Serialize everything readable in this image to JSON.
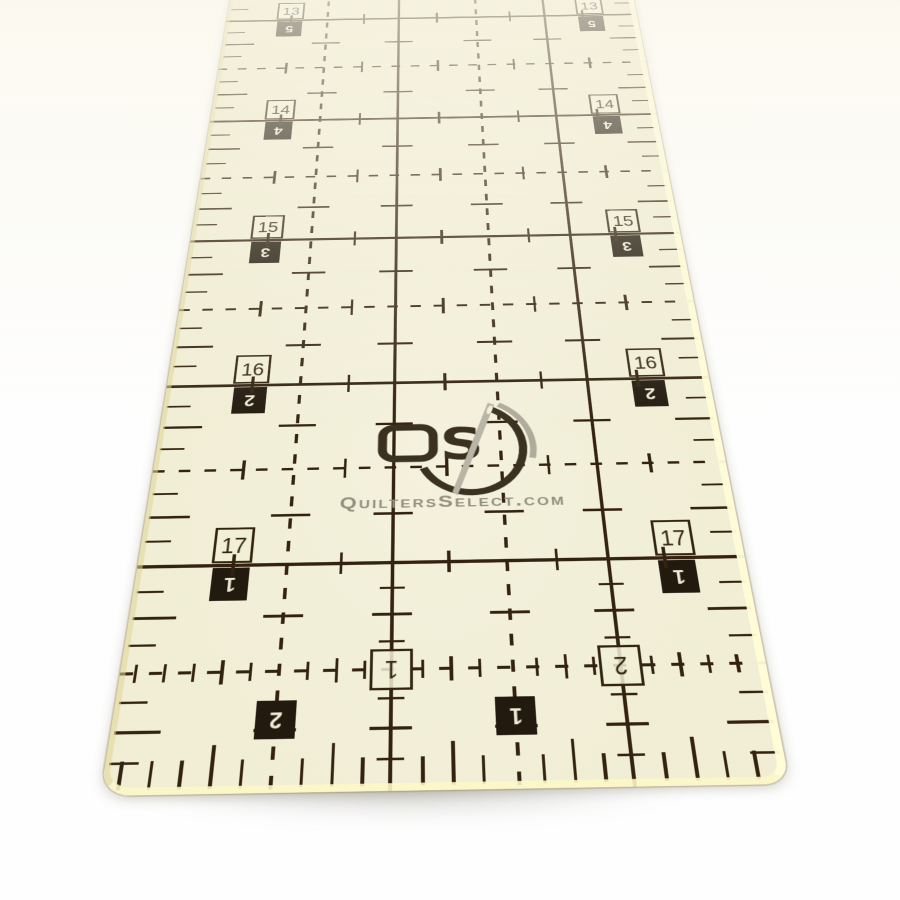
{
  "photo": {
    "description": "Quilters Select clear acrylic quilting ruler photographed at a low angle on a white background",
    "background_color": "#fefefe"
  },
  "ruler": {
    "colors": {
      "face": "#f1eed5",
      "line": "#33220f",
      "black_box": "#221a0e",
      "box_digit_light": "#efead6",
      "logo_dark": "#3a3120",
      "brand_gray": "#92907f",
      "needle_gray": "#b8b5a7",
      "edge_highlight": "#fdf8d0"
    },
    "inch_rows": [
      {
        "label": "13",
        "mirror_label": "5"
      },
      {
        "label": "14",
        "mirror_label": "4"
      },
      {
        "label": "15",
        "mirror_label": "3"
      },
      {
        "label": "16",
        "mirror_label": "2"
      },
      {
        "label": "17",
        "mirror_label": "1"
      }
    ],
    "bottom_columns": {
      "outlined_labels": [
        "1",
        "2"
      ],
      "black_labels": [
        "2",
        "1"
      ]
    },
    "brand": {
      "logo_letters": "QS",
      "logo_s": "S",
      "website": "QuiltersSelect.com"
    }
  }
}
